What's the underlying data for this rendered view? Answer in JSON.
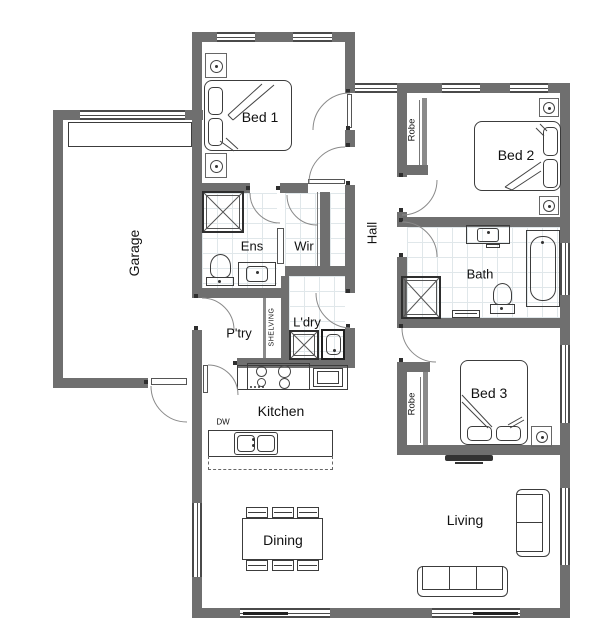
{
  "title": "House floor plan",
  "colors": {
    "wall": "#6f6f6f",
    "line": "#3c3c3c",
    "background": "#ffffff"
  },
  "rooms": {
    "garage": {
      "label": "Garage"
    },
    "bed1": {
      "label": "Bed 1"
    },
    "bed2": {
      "label": "Bed 2"
    },
    "bed3": {
      "label": "Bed 3"
    },
    "ens": {
      "label": "Ens"
    },
    "wir": {
      "label": "Wir"
    },
    "hall": {
      "label": "Hall"
    },
    "bath": {
      "label": "Bath"
    },
    "ptry": {
      "label": "P'try"
    },
    "ldry": {
      "label": "L'dry"
    },
    "kitchen": {
      "label": "Kitchen"
    },
    "dining": {
      "label": "Dining"
    },
    "living": {
      "label": "Living"
    }
  },
  "annotations": {
    "robe_bed2": "Robe",
    "robe_bed3": "Robe",
    "shelving": "SHELVING",
    "dishwasher": "DW"
  }
}
